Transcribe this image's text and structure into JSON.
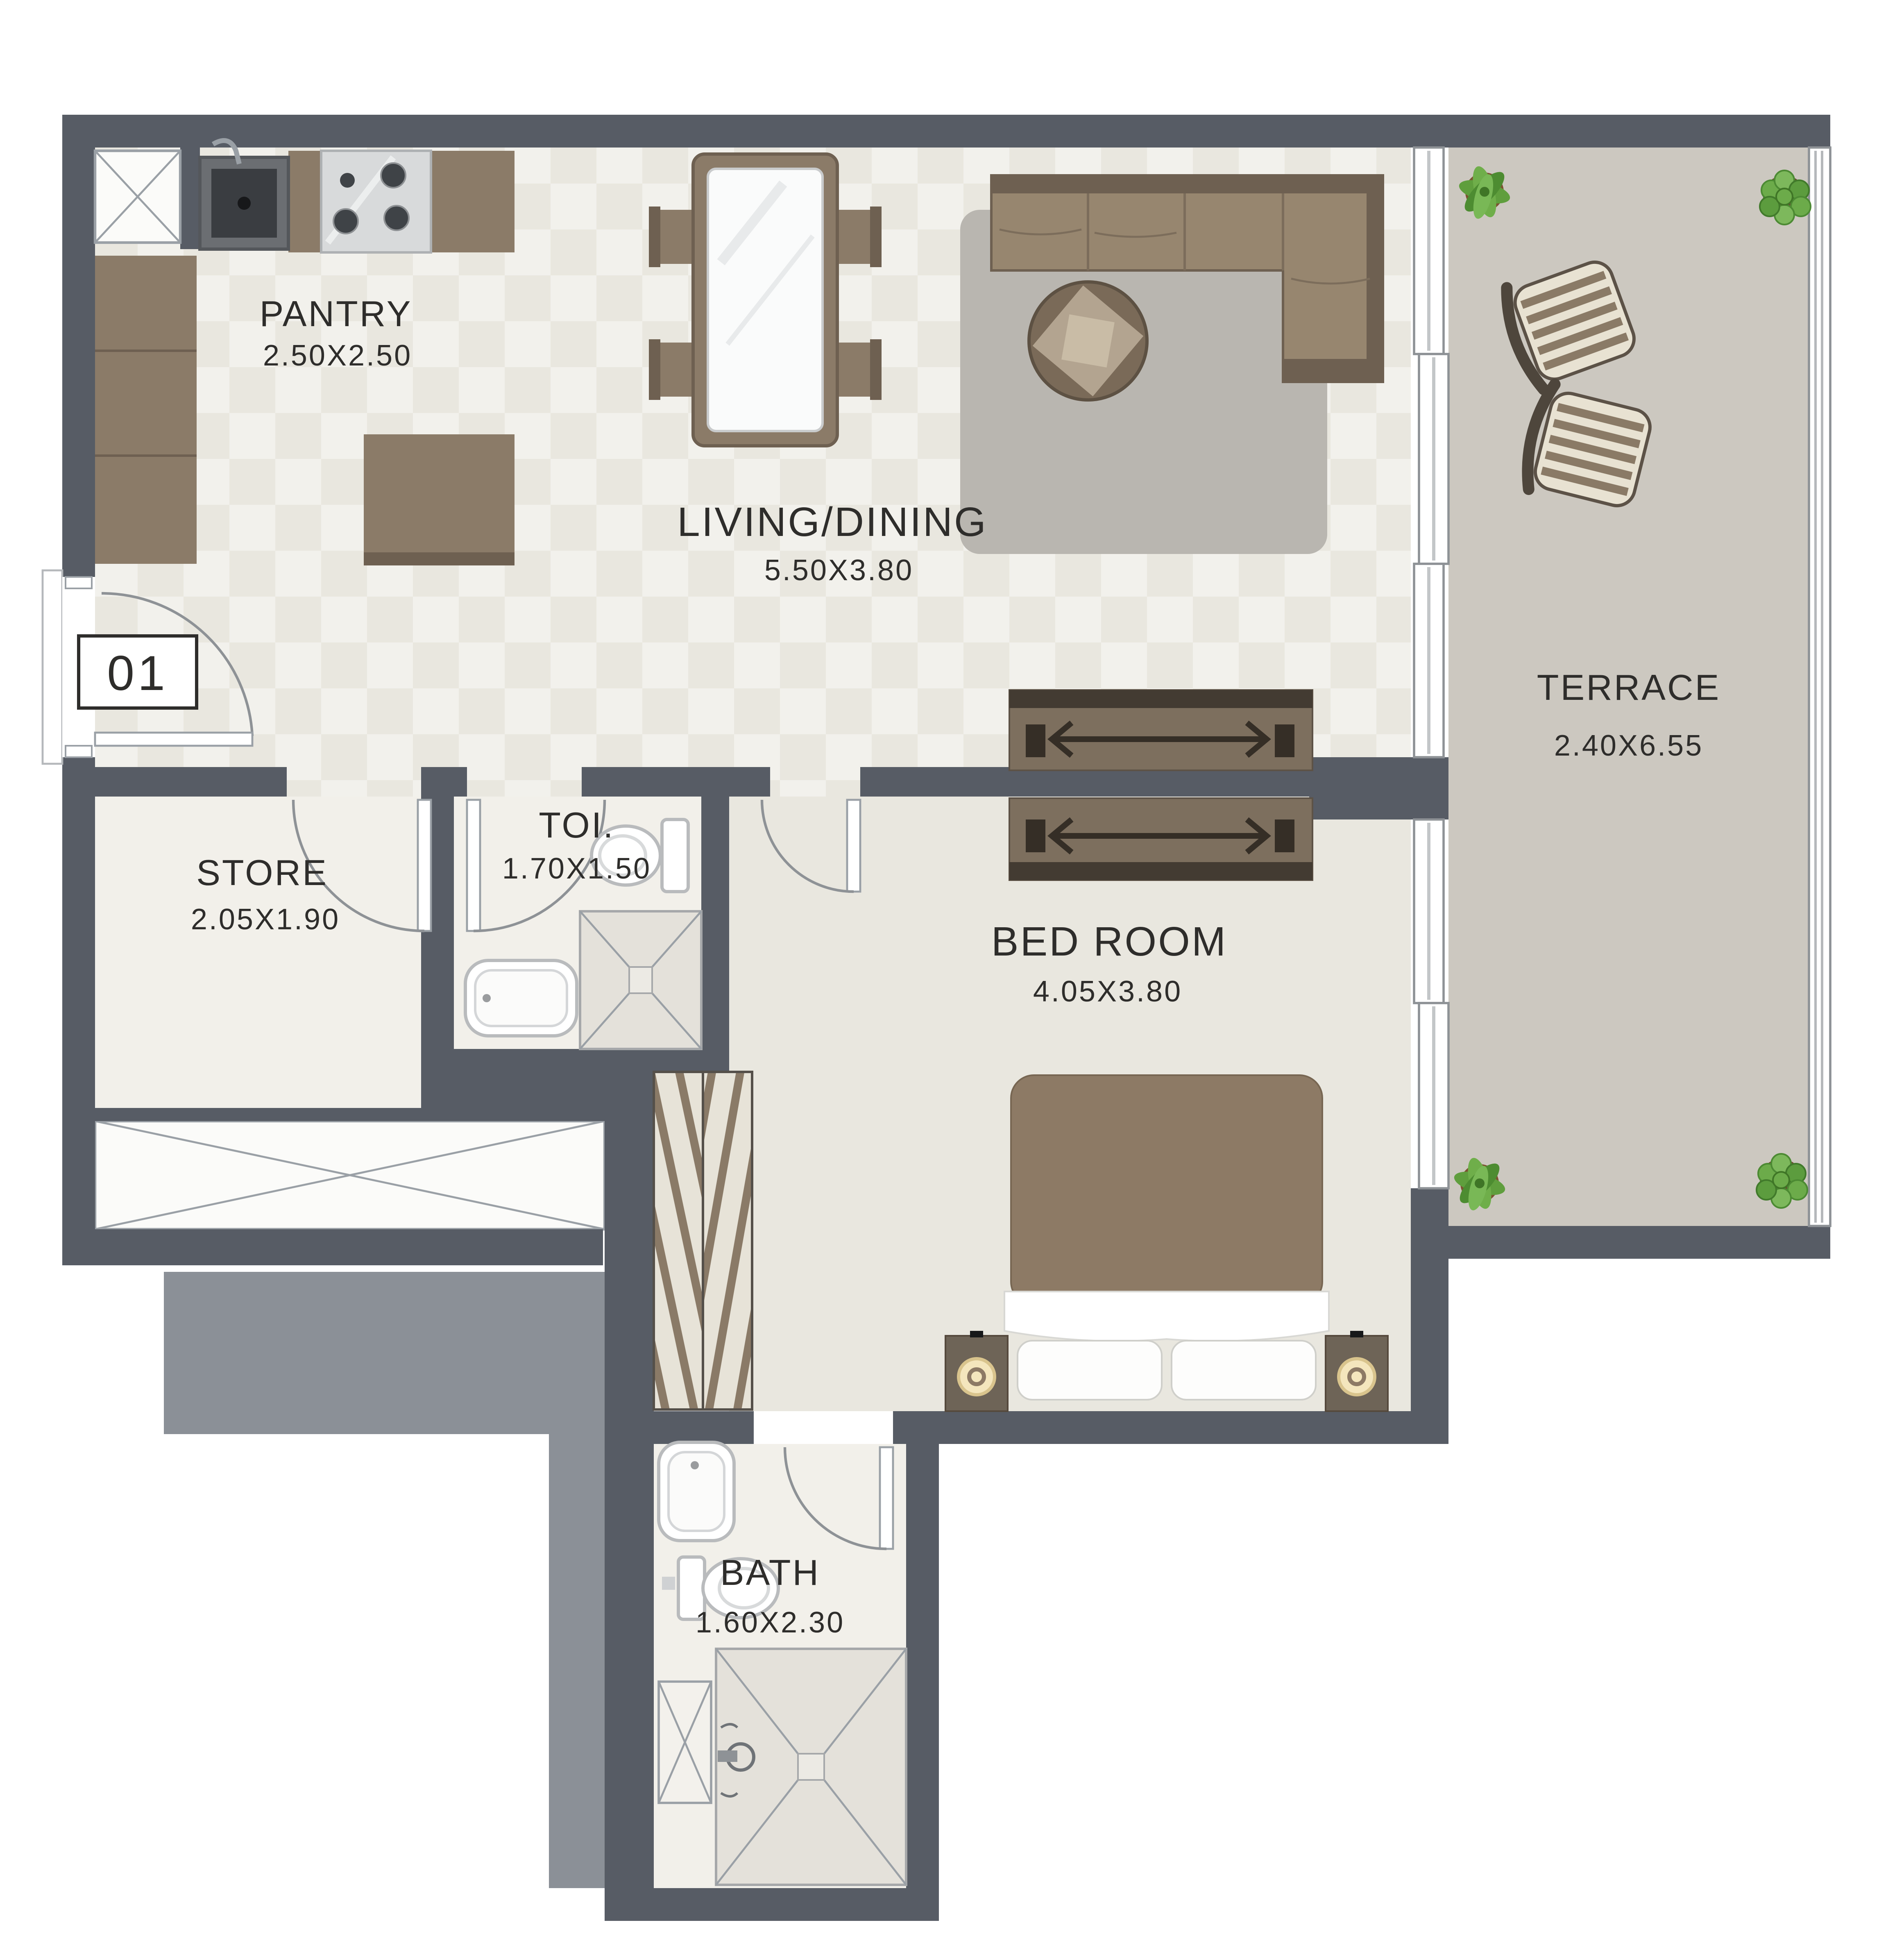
{
  "unit": {
    "number": "01"
  },
  "rooms": {
    "pantry": {
      "name": "PANTRY",
      "dimensions": "2.50X2.50"
    },
    "living_dining": {
      "name": "LIVING/DINING",
      "dimensions": "5.50X3.80"
    },
    "terrace": {
      "name": "TERRACE",
      "dimensions": "2.40X6.55"
    },
    "store": {
      "name": "STORE",
      "dimensions": "2.05X1.90"
    },
    "toilet": {
      "name": "TOI.",
      "dimensions": "1.70X1.50"
    },
    "bedroom": {
      "name": "BED ROOM",
      "dimensions": "4.05X3.80"
    },
    "bath": {
      "name": "BATH",
      "dimensions": "1.60X2.30"
    }
  },
  "colors": {
    "wall_dark": "#575c65",
    "wall_light": "#8b9097",
    "floor_main": "#e9e7df",
    "floor_wet": "#f2f0ea",
    "floor_terrace": "#ccc8c0",
    "furniture_brown": "#8b7b68",
    "plant_green": "#5f9e3d",
    "label_text": "#2e2d2b"
  }
}
